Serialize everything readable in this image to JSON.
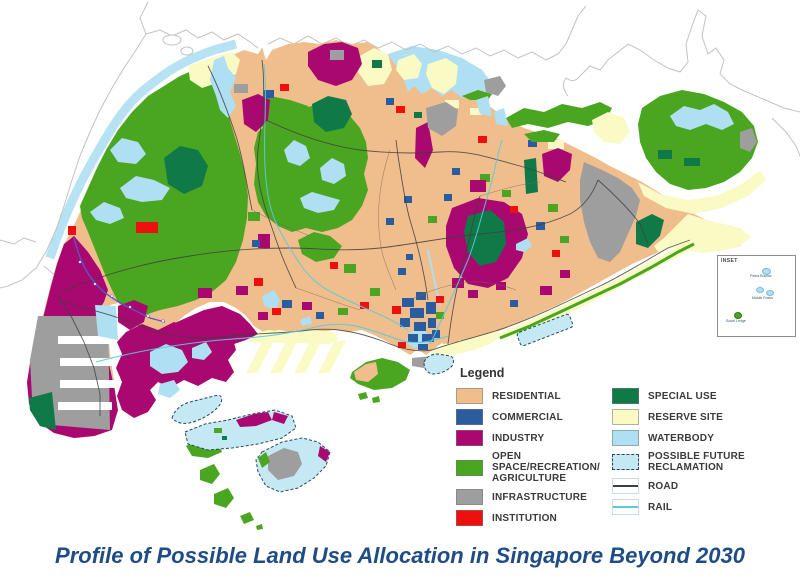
{
  "title": {
    "text": "Profile of Possible Land Use Allocation in Singapore Beyond 2030",
    "color": "#1F4C85"
  },
  "legend": {
    "title": "Legend",
    "left": [
      {
        "label": "RESIDENTIAL",
        "color": "#F0BE8D"
      },
      {
        "label": "COMMERCIAL",
        "color": "#2B5CA0"
      },
      {
        "label": "INDUSTRY",
        "color": "#A8086F"
      },
      {
        "label": "OPEN SPACE/RECREATION/ AGRICULTURE",
        "color": "#4AA620"
      },
      {
        "label": "INFRASTRUCTURE",
        "color": "#9E9E9E"
      },
      {
        "label": "INSTITUTION",
        "color": "#EE0F0F"
      }
    ],
    "right": [
      {
        "label": "SPECIAL USE",
        "color": "#0F7A48"
      },
      {
        "label": "RESERVE SITE",
        "color": "#FAFAC5"
      },
      {
        "label": "WATERBODY",
        "color": "#AEDFF2"
      },
      {
        "label": "POSSIBLE FUTURE RECLAMATION",
        "color": "#C5E8F5"
      },
      {
        "label": "ROAD",
        "color": "#3F3F3F"
      },
      {
        "label": "RAIL",
        "color": "#55CBDC"
      }
    ]
  },
  "inset": {
    "title": "INSET",
    "islands": [
      {
        "name": "Pedra Branca"
      },
      {
        "name": "Middle Rocks"
      },
      {
        "name": "South Ledge"
      }
    ]
  }
}
